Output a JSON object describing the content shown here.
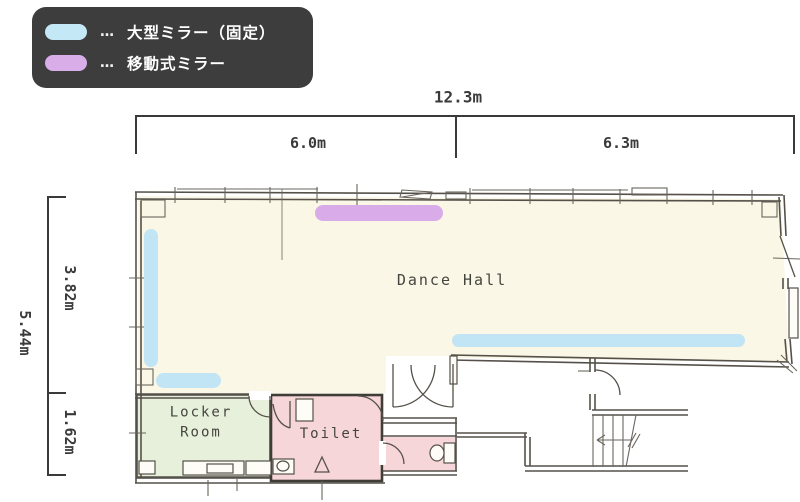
{
  "legend": {
    "items": [
      {
        "swatch": "fixed-mirror",
        "separator": "…",
        "label": "大型ミラー（固定）"
      },
      {
        "swatch": "movable-mirror",
        "separator": "…",
        "label": "移動式ミラー"
      }
    ]
  },
  "dimensions": {
    "total_width": "12.3m",
    "width_left": "6.0m",
    "width_right": "6.3m",
    "total_height": "5.44m",
    "height_upper": "3.82m",
    "height_lower": "1.62m"
  },
  "rooms": {
    "dance_hall": {
      "label": "Dance Hall"
    },
    "locker_room": {
      "label_line1": "Locker",
      "label_line2": "Room"
    },
    "toilet": {
      "label": "Toilet"
    }
  },
  "colors": {
    "fixed_mirror": "#c2e5f6",
    "movable_mirror": "#d9abe9",
    "dance_hall_fill": "#faf7e6",
    "locker_room_fill": "#e7f0db",
    "toilet_fill": "#f6d6d8",
    "wall": "#55514a",
    "legend_background": "#3d3d3d"
  }
}
